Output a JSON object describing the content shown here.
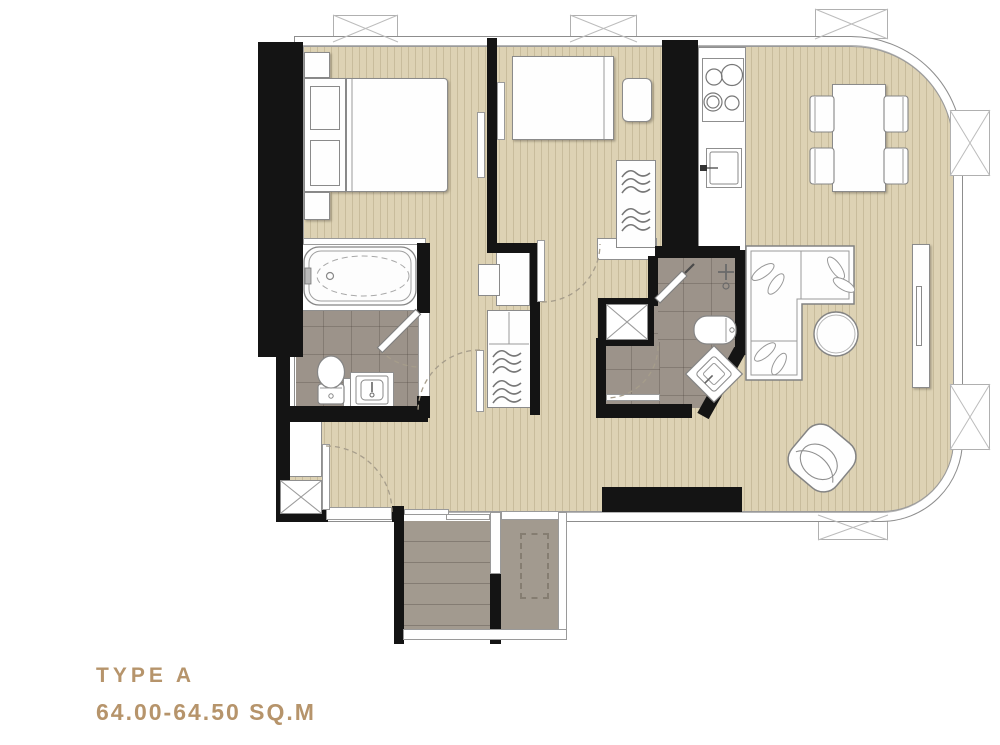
{
  "title": {
    "type_label": "TYPE A",
    "area_label": "64.00-64.50 SQ.M"
  },
  "colors": {
    "accent_text": "#B6946B",
    "wall": "#141414",
    "wood_floor": "#DDD2B4",
    "wood_stripe": "#C8BC9C",
    "bathroom_tile": "#9C938A",
    "balcony_tile": "#A29A8F",
    "furniture_outline": "#8A8A8A",
    "background": "#FFFFFF"
  },
  "plan": {
    "rooms": [
      "master-bedroom",
      "second-bedroom",
      "master-bathroom",
      "second-bathroom",
      "kitchen",
      "living-dining",
      "hallway",
      "balcony",
      "ac-ledge"
    ],
    "fixtures": [
      "double-bed",
      "single-bed",
      "bathtub",
      "toilet",
      "vanity-sink",
      "shower",
      "stove-4-burner",
      "kitchen-sink",
      "wardrobe-hangers",
      "desk",
      "dining-table-4-chairs",
      "l-sofa",
      "coffee-table",
      "armchair",
      "tv-console",
      "ac-condenser"
    ]
  }
}
